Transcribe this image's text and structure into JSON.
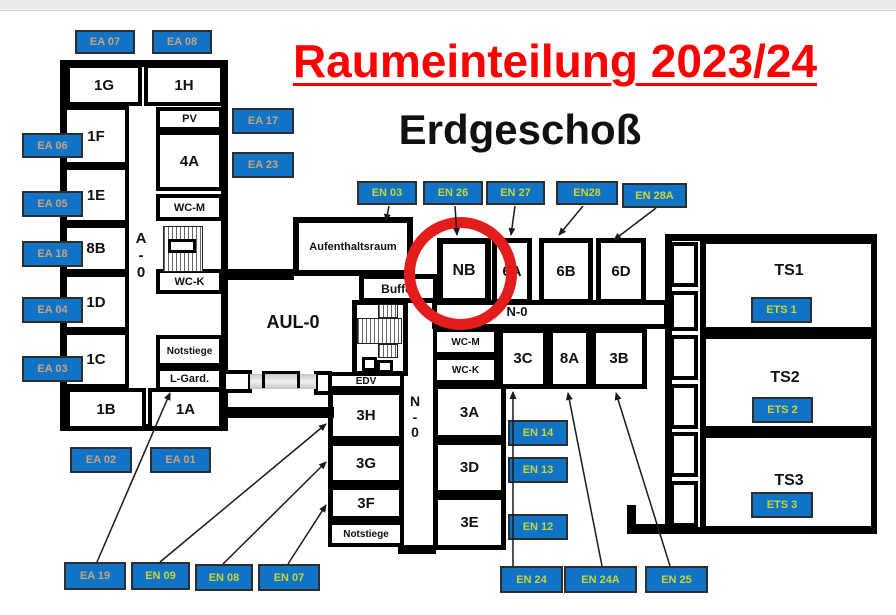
{
  "page": {
    "title": "Raumeinteilung 2023/24",
    "subtitle": "Erdgeschoß"
  },
  "colors": {
    "title_red": "#ff0000",
    "label_blue": "#1173c5",
    "ea_label_text": "#c9a47a",
    "en_label_text": "#c9d631",
    "wall_black": "#000000",
    "highlight_circle_red": "#e31c1c"
  },
  "plan": {
    "boxes": [
      {
        "id": "building-a-outline",
        "kind": "outline",
        "x": 60,
        "y": 60,
        "w": 168,
        "h": 371,
        "b": 7
      },
      {
        "id": "building-ts-outline",
        "kind": "outline",
        "x": 665,
        "y": 234,
        "w": 212,
        "h": 300,
        "b": 7
      },
      {
        "id": "corridor-en0",
        "kind": "room",
        "x": 432,
        "y": 300,
        "w": 237,
        "h": 29,
        "b": 5
      },
      {
        "id": "room-1g",
        "kind": "room",
        "x": 66,
        "y": 64,
        "w": 76,
        "h": 42,
        "b": 4,
        "label": "1G",
        "fs": 15
      },
      {
        "id": "room-1h",
        "kind": "room",
        "x": 144,
        "y": 64,
        "w": 80,
        "h": 42,
        "b": 4,
        "label": "1H",
        "fs": 15
      },
      {
        "id": "room-1f",
        "kind": "room",
        "x": 63,
        "y": 106,
        "w": 66,
        "h": 60,
        "b": 4,
        "label": "1F",
        "fs": 15
      },
      {
        "id": "room-1e",
        "kind": "room",
        "x": 63,
        "y": 166,
        "w": 66,
        "h": 58,
        "b": 4,
        "label": "1E",
        "fs": 15
      },
      {
        "id": "room-8b",
        "kind": "room",
        "x": 63,
        "y": 224,
        "w": 66,
        "h": 49,
        "b": 4,
        "label": "8B",
        "fs": 15
      },
      {
        "id": "room-1d",
        "kind": "room",
        "x": 63,
        "y": 273,
        "w": 66,
        "h": 58,
        "b": 4,
        "label": "1D",
        "fs": 15
      },
      {
        "id": "room-1c",
        "kind": "room",
        "x": 63,
        "y": 331,
        "w": 66,
        "h": 57,
        "b": 4,
        "label": "1C",
        "fs": 15
      },
      {
        "id": "room-1b",
        "kind": "room",
        "x": 66,
        "y": 388,
        "w": 80,
        "h": 42,
        "b": 4,
        "label": "1B",
        "fs": 15
      },
      {
        "id": "room-1a",
        "kind": "room",
        "x": 148,
        "y": 388,
        "w": 75,
        "h": 42,
        "b": 4,
        "label": "1A",
        "fs": 15
      },
      {
        "id": "room-pv",
        "kind": "room",
        "x": 156,
        "y": 107,
        "w": 67,
        "h": 24,
        "b": 4,
        "label": "PV",
        "fs": 11
      },
      {
        "id": "room-4a",
        "kind": "room",
        "x": 156,
        "y": 131,
        "w": 67,
        "h": 60,
        "b": 4,
        "label": "4A",
        "fs": 15
      },
      {
        "id": "room-wcm-a",
        "kind": "room",
        "x": 156,
        "y": 194,
        "w": 67,
        "h": 27,
        "b": 4,
        "label": "WC-M",
        "fs": 11
      },
      {
        "id": "room-wck-a",
        "kind": "room",
        "x": 156,
        "y": 269,
        "w": 67,
        "h": 25,
        "b": 4,
        "label": "WC-K",
        "fs": 11
      },
      {
        "id": "room-notstiege-a",
        "kind": "room",
        "x": 156,
        "y": 335,
        "w": 67,
        "h": 32,
        "b": 4,
        "label": "Notstiege",
        "fs": 10
      },
      {
        "id": "room-lgard",
        "kind": "room",
        "x": 156,
        "y": 367,
        "w": 67,
        "h": 24,
        "b": 4,
        "label": "L-Gard.",
        "fs": 11
      },
      {
        "id": "room-aufenthaltsraum",
        "kind": "room",
        "x": 293,
        "y": 217,
        "w": 120,
        "h": 59,
        "b": 6,
        "label": "Aufenthaltsraum",
        "fs": 11
      },
      {
        "id": "room-buffet",
        "kind": "room",
        "x": 359,
        "y": 274,
        "w": 79,
        "h": 29,
        "b": 5,
        "label": "Buffet",
        "fs": 12
      },
      {
        "id": "room-nb",
        "kind": "room",
        "x": 437,
        "y": 238,
        "w": 54,
        "h": 66,
        "b": 6,
        "label": "NB",
        "fs": 16
      },
      {
        "id": "room-6a",
        "kind": "room",
        "x": 492,
        "y": 238,
        "w": 40,
        "h": 66,
        "b": 5,
        "label": "6A",
        "fs": 15
      },
      {
        "id": "room-6b",
        "kind": "room",
        "x": 539,
        "y": 238,
        "w": 54,
        "h": 66,
        "b": 5,
        "label": "6B",
        "fs": 15
      },
      {
        "id": "room-6d",
        "kind": "room",
        "x": 596,
        "y": 238,
        "w": 50,
        "h": 66,
        "b": 5,
        "label": "6D",
        "fs": 15
      },
      {
        "id": "room-wcm-n",
        "kind": "room",
        "x": 433,
        "y": 328,
        "w": 65,
        "h": 28,
        "b": 4,
        "label": "WC-M",
        "fs": 10
      },
      {
        "id": "room-wck-n",
        "kind": "room",
        "x": 433,
        "y": 356,
        "w": 65,
        "h": 28,
        "b": 4,
        "label": "WC-K",
        "fs": 10
      },
      {
        "id": "room-3c",
        "kind": "room",
        "x": 498,
        "y": 328,
        "w": 50,
        "h": 61,
        "b": 5,
        "label": "3C",
        "fs": 15
      },
      {
        "id": "room-8a",
        "kind": "room",
        "x": 548,
        "y": 328,
        "w": 43,
        "h": 61,
        "b": 5,
        "label": "8A",
        "fs": 15
      },
      {
        "id": "room-3b",
        "kind": "room",
        "x": 591,
        "y": 328,
        "w": 56,
        "h": 61,
        "b": 5,
        "label": "3B",
        "fs": 15
      },
      {
        "id": "room-3a",
        "kind": "room",
        "x": 433,
        "y": 384,
        "w": 73,
        "h": 56,
        "b": 5,
        "label": "3A",
        "fs": 15
      },
      {
        "id": "room-3d",
        "kind": "room",
        "x": 433,
        "y": 440,
        "w": 73,
        "h": 55,
        "b": 5,
        "label": "3D",
        "fs": 15
      },
      {
        "id": "room-3e",
        "kind": "room",
        "x": 433,
        "y": 495,
        "w": 73,
        "h": 55,
        "b": 5,
        "label": "3E",
        "fs": 15
      },
      {
        "id": "room-edv",
        "kind": "room",
        "x": 328,
        "y": 372,
        "w": 76,
        "h": 18,
        "b": 4,
        "label": "EDV",
        "fs": 10
      },
      {
        "id": "room-3h",
        "kind": "room",
        "x": 328,
        "y": 390,
        "w": 76,
        "h": 51,
        "b": 5,
        "label": "3H",
        "fs": 15
      },
      {
        "id": "room-3g",
        "kind": "room",
        "x": 328,
        "y": 441,
        "w": 76,
        "h": 44,
        "b": 5,
        "label": "3G",
        "fs": 15
      },
      {
        "id": "room-3f",
        "kind": "room",
        "x": 328,
        "y": 485,
        "w": 76,
        "h": 36,
        "b": 5,
        "label": "3F",
        "fs": 15
      },
      {
        "id": "room-notstiege-n",
        "kind": "room",
        "x": 328,
        "y": 521,
        "w": 76,
        "h": 26,
        "b": 4,
        "label": "Notstiege",
        "fs": 10
      },
      {
        "id": "room-ts1",
        "kind": "room",
        "x": 700,
        "y": 238,
        "w": 177,
        "h": 95,
        "b": 6
      },
      {
        "id": "room-ts2",
        "kind": "room",
        "x": 700,
        "y": 333,
        "w": 177,
        "h": 99,
        "b": 6
      },
      {
        "id": "room-ts3",
        "kind": "room",
        "x": 700,
        "y": 432,
        "w": 177,
        "h": 100,
        "b": 6
      },
      {
        "id": "ts-link-box-1",
        "kind": "room",
        "x": 670,
        "y": 242,
        "w": 28,
        "h": 45,
        "b": 4
      },
      {
        "id": "ts-link-box-2",
        "kind": "room",
        "x": 670,
        "y": 291,
        "w": 28,
        "h": 40,
        "b": 4
      },
      {
        "id": "ts-link-box-3",
        "kind": "room",
        "x": 670,
        "y": 335,
        "w": 28,
        "h": 45,
        "b": 4
      },
      {
        "id": "ts-link-box-4",
        "kind": "room",
        "x": 670,
        "y": 384,
        "w": 28,
        "h": 45,
        "b": 4
      },
      {
        "id": "ts-link-box-5",
        "kind": "room",
        "x": 670,
        "y": 432,
        "w": 28,
        "h": 45,
        "b": 4
      },
      {
        "id": "ts-link-box-6",
        "kind": "room",
        "x": 670,
        "y": 481,
        "w": 28,
        "h": 46,
        "b": 4
      },
      {
        "id": "passage-box-west",
        "kind": "room",
        "x": 222,
        "y": 370,
        "w": 30,
        "h": 23,
        "b": 4
      },
      {
        "id": "passage-box-east",
        "kind": "room",
        "x": 314,
        "y": 371,
        "w": 18,
        "h": 24,
        "b": 4
      },
      {
        "id": "stair-shaft-mid",
        "kind": "room",
        "x": 352,
        "y": 300,
        "w": 56,
        "h": 76,
        "b": 5
      },
      {
        "id": "wall-aula-north",
        "kind": "wall",
        "x": 224,
        "y": 269,
        "w": 70,
        "h": 11
      },
      {
        "id": "wall-aula-south",
        "kind": "wall",
        "x": 222,
        "y": 407,
        "w": 112,
        "h": 11
      },
      {
        "id": "wall-n0-south",
        "kind": "wall",
        "x": 398,
        "y": 545,
        "w": 38,
        "h": 9
      },
      {
        "id": "wall-foot-vertical",
        "kind": "wall",
        "x": 627,
        "y": 505,
        "w": 9,
        "h": 29
      },
      {
        "id": "wall-foot-horizontal",
        "kind": "wall",
        "x": 627,
        "y": 524,
        "w": 42,
        "h": 10
      },
      {
        "id": "stair-a-hatch",
        "kind": "stair",
        "x": 163,
        "y": 226,
        "w": 40,
        "h": 46
      },
      {
        "id": "stair-a-landing",
        "kind": "room",
        "x": 168,
        "y": 239,
        "w": 28,
        "h": 14,
        "b": 3
      },
      {
        "id": "stair-mid-hatch-top",
        "kind": "stair",
        "x": 378,
        "y": 304,
        "w": 20,
        "h": 14
      },
      {
        "id": "stair-mid-hatch-main",
        "kind": "stair",
        "x": 357,
        "y": 318,
        "w": 45,
        "h": 26
      },
      {
        "id": "stair-mid-hatch-bottom",
        "kind": "stair",
        "x": 378,
        "y": 344,
        "w": 20,
        "h": 14
      },
      {
        "id": "stair-mid-step-west",
        "kind": "room",
        "x": 362,
        "y": 357,
        "w": 15,
        "h": 14,
        "b": 3
      },
      {
        "id": "stair-mid-step-east",
        "kind": "room",
        "x": 377,
        "y": 360,
        "w": 16,
        "h": 13,
        "b": 3
      },
      {
        "id": "passage-band",
        "kind": "pass",
        "x": 250,
        "y": 374,
        "w": 66,
        "h": 15
      },
      {
        "id": "passage-door-bracket",
        "kind": "bracket",
        "x": 262,
        "y": 371,
        "w": 38,
        "h": 17
      },
      {
        "id": "highlight-circle-nb",
        "kind": "ring",
        "x": 404,
        "y": 217,
        "w": 113,
        "h": 113
      }
    ],
    "texts": [
      {
        "id": "corridor-aul0-label",
        "text": "AUL-0",
        "x": 258,
        "y": 312,
        "w": 70,
        "fs": 18
      },
      {
        "id": "corridor-n0-horizontal-label",
        "text": "N-0",
        "x": 492,
        "y": 305,
        "w": 50,
        "fs": 13
      },
      {
        "id": "corridor-a0-vertical-label",
        "text": "A\n-\n0",
        "x": 128,
        "y": 231,
        "w": 26,
        "fs": 15
      },
      {
        "id": "corridor-n0-vertical-label",
        "text": "N\n-\n0",
        "x": 402,
        "y": 394,
        "w": 26,
        "fs": 14
      },
      {
        "id": "room-ts1-label",
        "text": "TS1",
        "x": 758,
        "y": 262,
        "w": 62,
        "fs": 16
      },
      {
        "id": "room-ts2-label",
        "text": "TS2",
        "x": 754,
        "y": 369,
        "w": 62,
        "fs": 16
      },
      {
        "id": "room-ts3-label",
        "text": "TS3",
        "x": 758,
        "y": 472,
        "w": 62,
        "fs": 16
      }
    ],
    "tags": [
      {
        "text": "EA 07",
        "cat": "ea",
        "x": 75,
        "y": 30,
        "w": 60,
        "h": 24
      },
      {
        "text": "EA 08",
        "cat": "ea",
        "x": 152,
        "y": 30,
        "w": 60,
        "h": 24
      },
      {
        "text": "EA 17",
        "cat": "ea",
        "x": 232,
        "y": 108,
        "w": 62,
        "h": 26
      },
      {
        "text": "EA 23",
        "cat": "ea",
        "x": 232,
        "y": 152,
        "w": 62,
        "h": 26
      },
      {
        "text": "EA 06",
        "cat": "ea",
        "x": 22,
        "y": 133,
        "w": 61,
        "h": 25
      },
      {
        "text": "EA 05",
        "cat": "ea",
        "x": 22,
        "y": 191,
        "w": 61,
        "h": 26
      },
      {
        "text": "EA 18",
        "cat": "ea",
        "x": 22,
        "y": 241,
        "w": 61,
        "h": 26
      },
      {
        "text": "EA 04",
        "cat": "ea",
        "x": 22,
        "y": 297,
        "w": 61,
        "h": 26
      },
      {
        "text": "EA 03",
        "cat": "ea",
        "x": 22,
        "y": 356,
        "w": 61,
        "h": 26
      },
      {
        "text": "EA 02",
        "cat": "ea",
        "x": 70,
        "y": 447,
        "w": 62,
        "h": 26
      },
      {
        "text": "EA 01",
        "cat": "ea",
        "x": 150,
        "y": 447,
        "w": 61,
        "h": 26
      },
      {
        "text": "EA 19",
        "cat": "ea",
        "x": 64,
        "y": 562,
        "w": 62,
        "h": 28
      },
      {
        "text": "EN 09",
        "cat": "en",
        "x": 131,
        "y": 562,
        "w": 59,
        "h": 28
      },
      {
        "text": "EN 08",
        "cat": "en",
        "x": 195,
        "y": 564,
        "w": 58,
        "h": 27
      },
      {
        "text": "EN 07",
        "cat": "en",
        "x": 258,
        "y": 564,
        "w": 62,
        "h": 27
      },
      {
        "text": "EN 03",
        "cat": "en",
        "x": 357,
        "y": 181,
        "w": 60,
        "h": 24
      },
      {
        "text": "EN 26",
        "cat": "en",
        "x": 423,
        "y": 181,
        "w": 60,
        "h": 24
      },
      {
        "text": "EN 27",
        "cat": "en",
        "x": 486,
        "y": 181,
        "w": 59,
        "h": 24
      },
      {
        "text": "EN28",
        "cat": "en",
        "x": 556,
        "y": 181,
        "w": 62,
        "h": 24
      },
      {
        "text": "EN 28A",
        "cat": "en",
        "x": 622,
        "y": 183,
        "w": 65,
        "h": 25
      },
      {
        "text": "EN 14",
        "cat": "en",
        "x": 508,
        "y": 420,
        "w": 60,
        "h": 26
      },
      {
        "text": "EN 13",
        "cat": "en",
        "x": 508,
        "y": 457,
        "w": 60,
        "h": 26
      },
      {
        "text": "EN 12",
        "cat": "en",
        "x": 508,
        "y": 514,
        "w": 60,
        "h": 26
      },
      {
        "text": "EN 24",
        "cat": "en",
        "x": 500,
        "y": 566,
        "w": 63,
        "h": 27
      },
      {
        "text": "EN 24A",
        "cat": "en",
        "x": 564,
        "y": 566,
        "w": 73,
        "h": 27
      },
      {
        "text": "EN 25",
        "cat": "en",
        "x": 645,
        "y": 566,
        "w": 63,
        "h": 27
      },
      {
        "text": "ETS 1",
        "cat": "en",
        "x": 751,
        "y": 297,
        "w": 61,
        "h": 26
      },
      {
        "text": "ETS 2",
        "cat": "en",
        "x": 752,
        "y": 397,
        "w": 61,
        "h": 26
      },
      {
        "text": "ETS 3",
        "cat": "en",
        "x": 751,
        "y": 492,
        "w": 62,
        "h": 26
      }
    ],
    "arrows": [
      {
        "x1": 97,
        "y1": 562,
        "x2": 170,
        "y2": 393
      },
      {
        "x1": 160,
        "y1": 562,
        "x2": 326,
        "y2": 424
      },
      {
        "x1": 223,
        "y1": 564,
        "x2": 326,
        "y2": 462
      },
      {
        "x1": 288,
        "y1": 564,
        "x2": 326,
        "y2": 505
      },
      {
        "x1": 389,
        "y1": 206,
        "x2": 386,
        "y2": 221
      },
      {
        "x1": 455,
        "y1": 206,
        "x2": 457,
        "y2": 235
      },
      {
        "x1": 515,
        "y1": 206,
        "x2": 511,
        "y2": 235
      },
      {
        "x1": 583,
        "y1": 206,
        "x2": 559,
        "y2": 235
      },
      {
        "x1": 656,
        "y1": 208,
        "x2": 614,
        "y2": 240
      },
      {
        "x1": 513,
        "y1": 566,
        "x2": 513,
        "y2": 392
      },
      {
        "x1": 602,
        "y1": 566,
        "x2": 568,
        "y2": 393
      },
      {
        "x1": 670,
        "y1": 566,
        "x2": 616,
        "y2": 393
      }
    ]
  }
}
